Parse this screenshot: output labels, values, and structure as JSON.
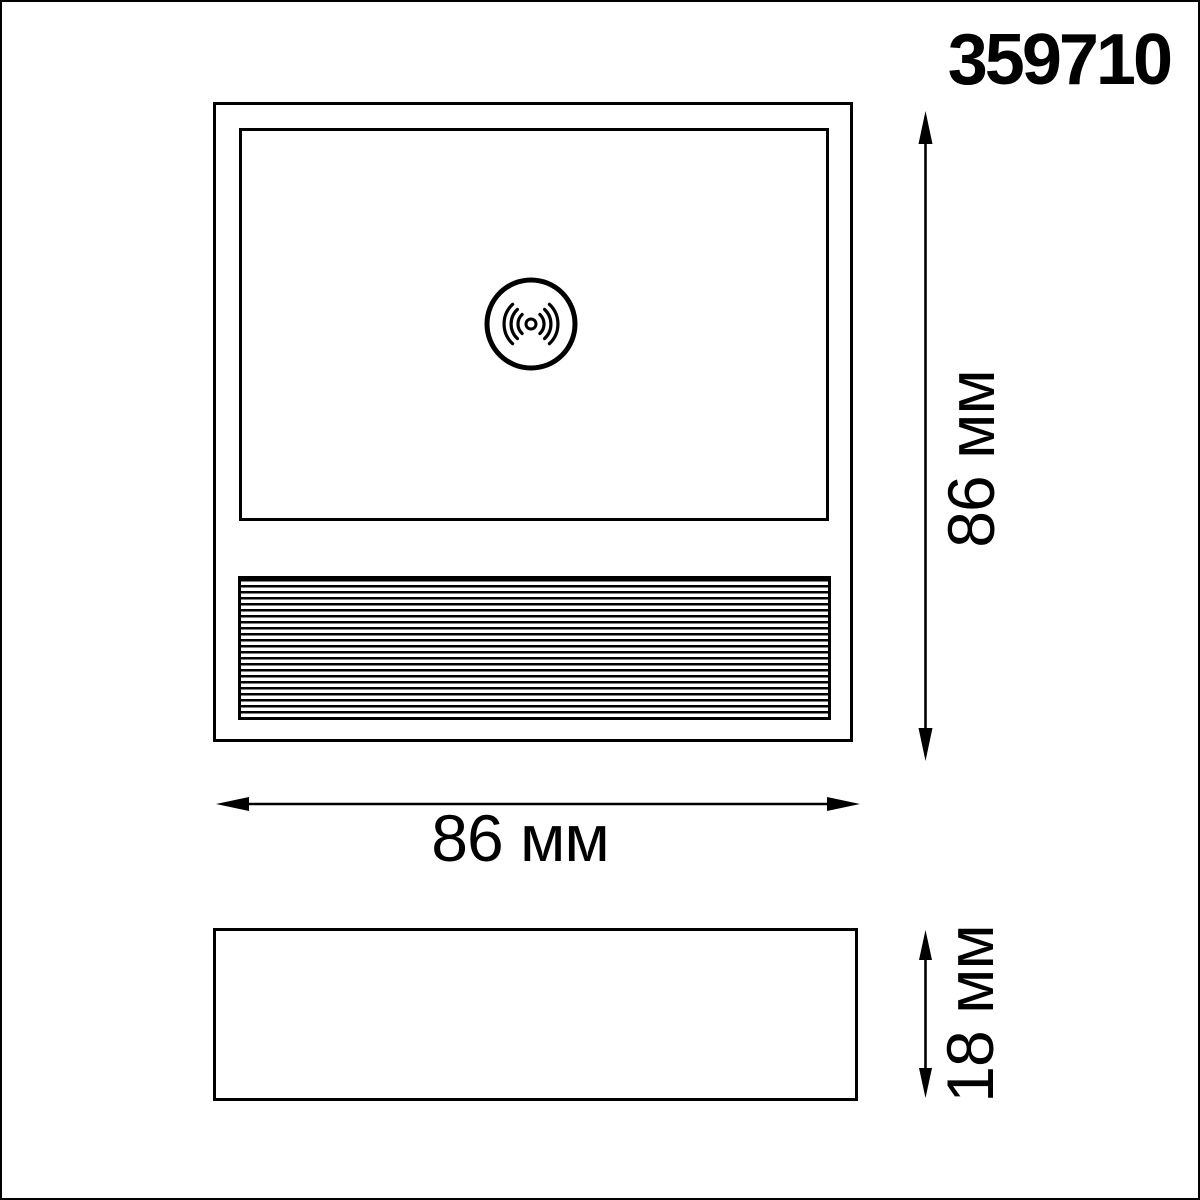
{
  "product": {
    "code": "359710"
  },
  "colors": {
    "line": "#000000",
    "background": "#ffffff"
  },
  "dimensions": {
    "height": "86 мм",
    "width": "86 мм",
    "depth": "18 мм"
  },
  "views": {
    "front": {
      "label": "front-view",
      "icon": "motion-sensor-icon",
      "grille": "ventilation-grille"
    },
    "side": {
      "label": "side-view"
    }
  }
}
